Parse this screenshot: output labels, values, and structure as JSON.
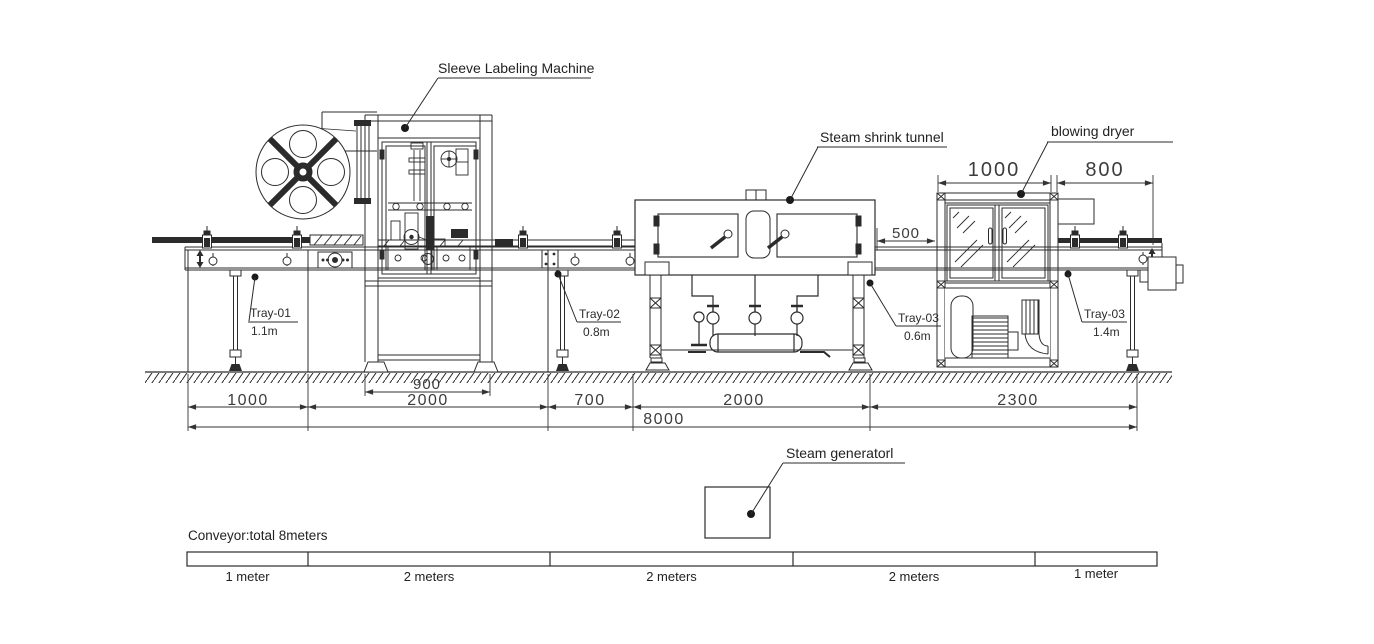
{
  "labels": {
    "sleeve_labeling_machine": "Sleeve Labeling Machine",
    "steam_shrink_tunnel": "Steam shrink tunnel",
    "blowing_dryer": "blowing dryer",
    "steam_generator": "Steam generatorl"
  },
  "trays": [
    {
      "name": "Tray-01",
      "height": "1.1m"
    },
    {
      "name": "Tray-02",
      "height": "0.8m"
    },
    {
      "name": "Tray-03",
      "height": "0.6m"
    },
    {
      "name": "Tray-03",
      "height": "1.4m"
    }
  ],
  "dims": {
    "dryer_width": "1000",
    "outfeed_width": "800",
    "tunnel_dryer_gap": "500",
    "labeler_feet": "900",
    "infeed": "1000",
    "labeler": "2000",
    "labeler_tunnel_gap": "700",
    "tunnel": "2000",
    "outfeed": "2300",
    "total": "8000"
  },
  "conveyor": {
    "title": "Conveyor:total 8meters",
    "segments": [
      {
        "label": "1 meter"
      },
      {
        "label": "2 meters"
      },
      {
        "label": "2 meters"
      },
      {
        "label": "2 meters"
      },
      {
        "label": "1 meter"
      }
    ]
  },
  "colors": {
    "line": "#2b2b2b",
    "background": "#ffffff"
  }
}
